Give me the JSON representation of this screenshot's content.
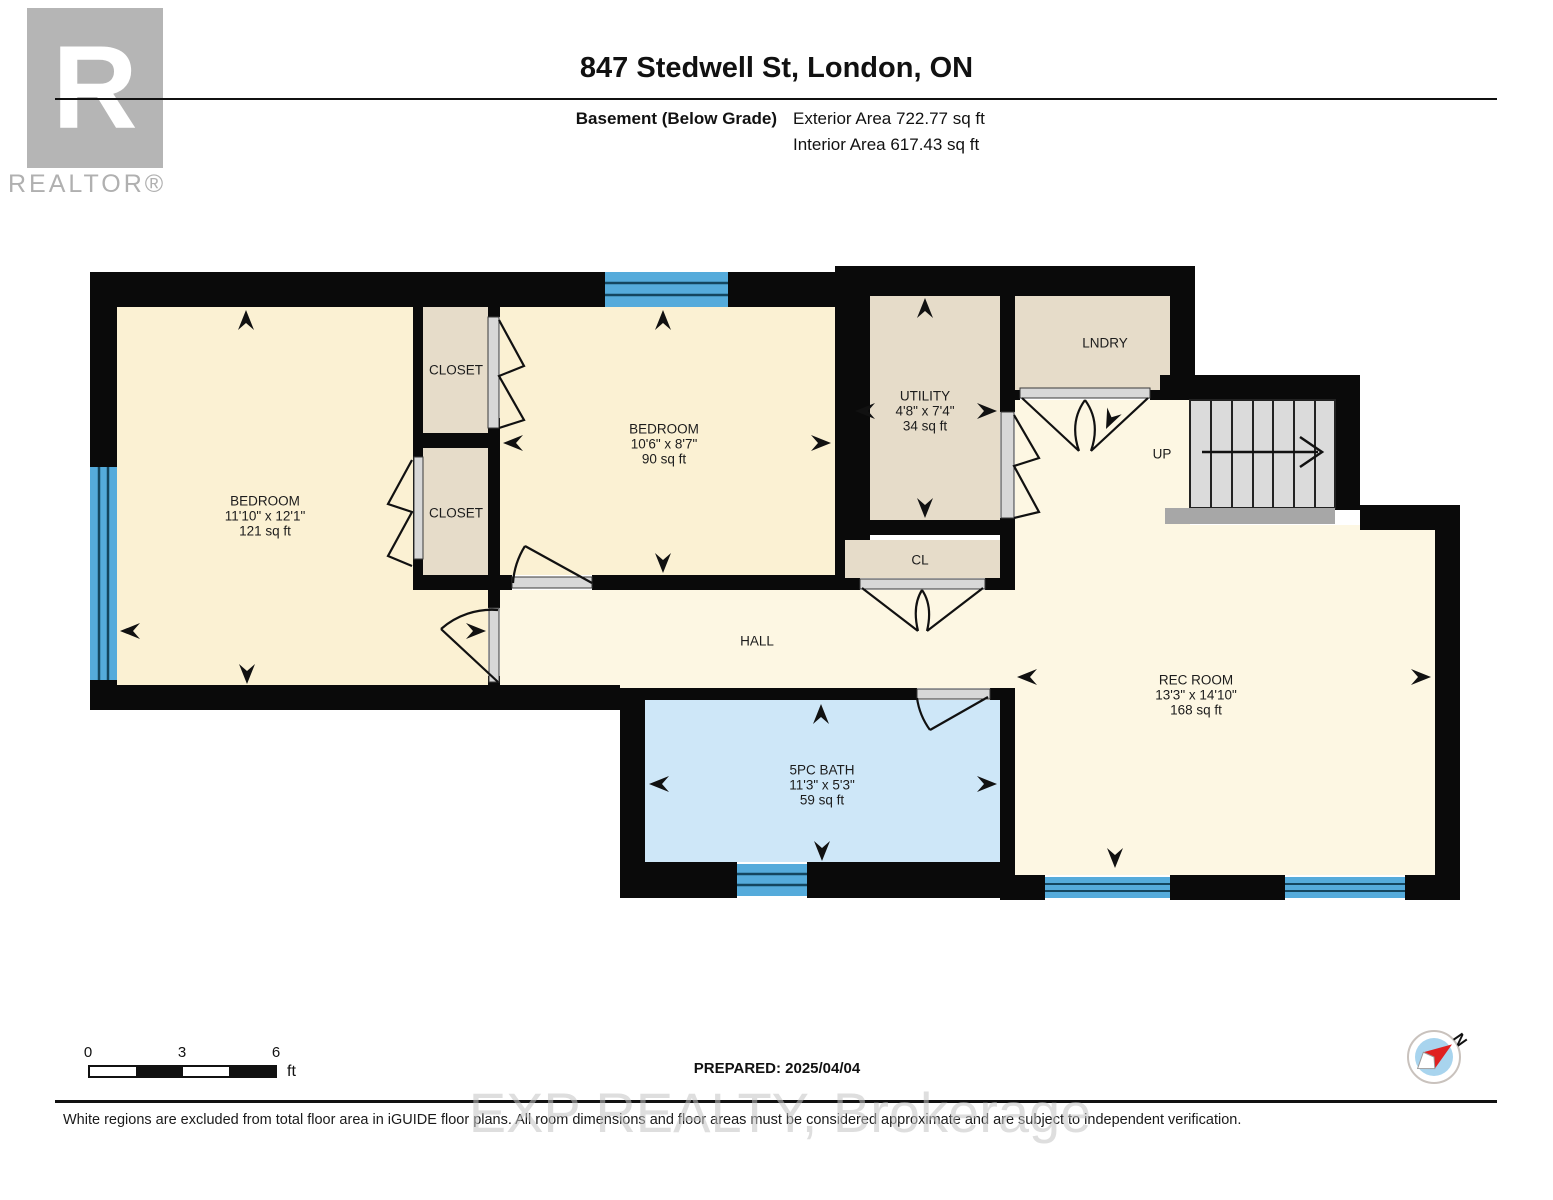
{
  "header": {
    "title": "847 Stedwell St, London, ON",
    "floor_label": "Basement (Below Grade)",
    "exterior_area": "Exterior Area 722.77 sq ft",
    "interior_area": "Interior Area 617.43 sq ft"
  },
  "logo": {
    "letter": "R",
    "brand": "REALTOR®"
  },
  "rooms": [
    {
      "name": "BEDROOM",
      "dims": "11'10\" x 12'1\"",
      "area": "121 sq ft"
    },
    {
      "name": "CLOSET"
    },
    {
      "name": "CLOSET"
    },
    {
      "name": "BEDROOM",
      "dims": "10'6\" x 8'7\"",
      "area": "90 sq ft"
    },
    {
      "name": "UTILITY",
      "dims": "4'8\" x 7'4\"",
      "area": "34 sq ft"
    },
    {
      "name": "LNDRY"
    },
    {
      "name": "CL"
    },
    {
      "name": "HALL"
    },
    {
      "name": "5PC BATH",
      "dims": "11'3\" x 5'3\"",
      "area": "59 sq ft"
    },
    {
      "name": "REC ROOM",
      "dims": "13'3\" x 14'10\"",
      "area": "168 sq ft"
    },
    {
      "name": "UP"
    }
  ],
  "scale_bar": {
    "tick0": "0",
    "tick1": "3",
    "tick2": "6",
    "unit": "ft"
  },
  "compass": {
    "north_label": "N"
  },
  "footer": {
    "prepared": "PREPARED: 2025/04/04",
    "disclaimer": "White regions are excluded from total floor area in iGUIDE floor plans. All room dimensions and floor areas must be considered approximate and are subject to independent verification.",
    "watermark": "EXP REALTY, Brokerage"
  },
  "colors": {
    "wall": "#0a0a0a",
    "room_cream": "#FBF1D3",
    "room_cream_light": "#FDF7E3",
    "closet_tan": "#E6DCC9",
    "bath_blue": "#CEE7F8",
    "window_blue": "#55ABDB",
    "stairs_gray": "#DBDBDB",
    "compass_red": "#E02020"
  }
}
